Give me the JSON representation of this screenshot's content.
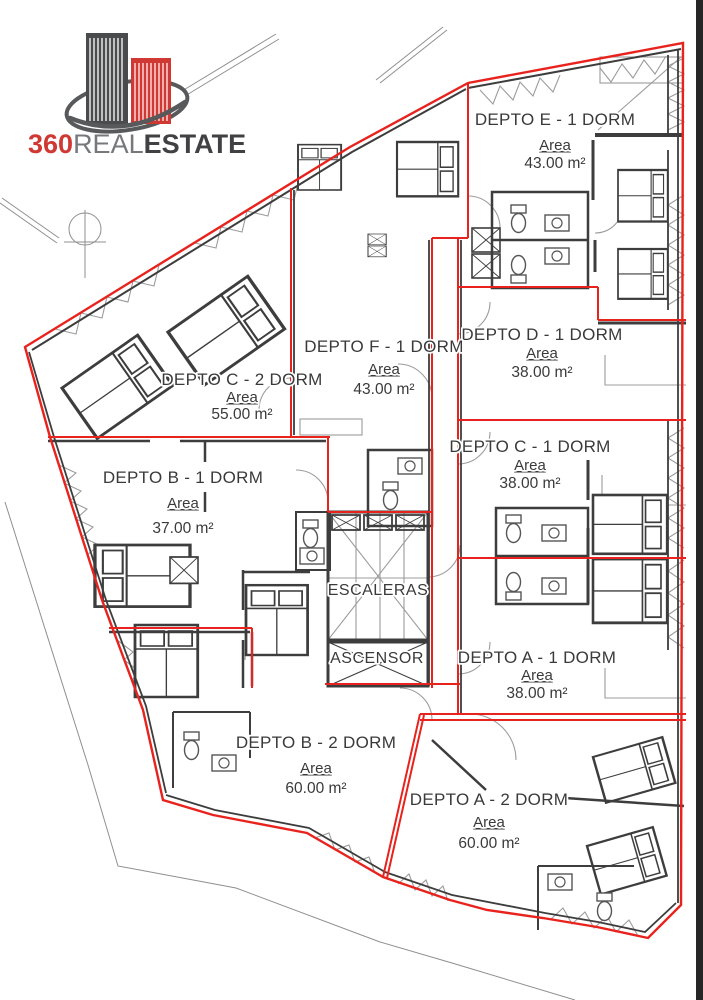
{
  "page": {
    "background": "#ffffff"
  },
  "logo": {
    "text_360": "360",
    "text_real": "REAL",
    "text_estate": "ESTATE",
    "color_red": "#cf3833",
    "color_gray": "#77787b",
    "color_dark": "#414042"
  },
  "plan": {
    "boundary_color": "#e8231e",
    "wall_color": "#3d3d3d",
    "area_label": "Area",
    "core": {
      "stairs_label": "ESCALERAS",
      "elevator_label": "ASCENSOR"
    },
    "units": [
      {
        "id": "depto-e",
        "title": "DEPTO E - 1 DORM",
        "area": "43.00 m²"
      },
      {
        "id": "depto-d",
        "title": "DEPTO D - 1 DORM",
        "area": "38.00 m²"
      },
      {
        "id": "depto-c1",
        "title": "DEPTO C - 1 DORM",
        "area": "38.00 m²"
      },
      {
        "id": "depto-a1",
        "title": "DEPTO A - 1 DORM",
        "area": "38.00 m²"
      },
      {
        "id": "depto-f",
        "title": "DEPTO F - 1 DORM",
        "area": "43.00 m²"
      },
      {
        "id": "depto-c2",
        "title": "DEPTO C - 2 DORM",
        "area": "55.00 m²"
      },
      {
        "id": "depto-b1",
        "title": "DEPTO B - 1 DORM",
        "area": "37.00 m²"
      },
      {
        "id": "depto-b2",
        "title": "DEPTO B - 2 DORM",
        "area": "60.00 m²"
      },
      {
        "id": "depto-a2",
        "title": "DEPTO A - 2 DORM",
        "area": "60.00 m²"
      }
    ]
  }
}
